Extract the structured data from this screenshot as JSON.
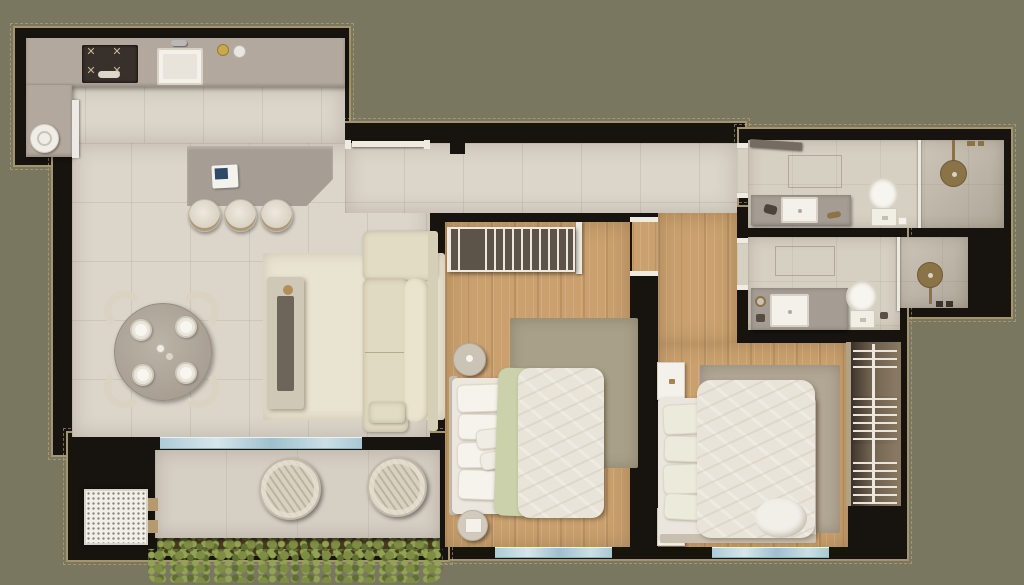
{
  "scene": {
    "kind": "3D-rendered apartment floor plan, top-down view",
    "background_color": "#7a7761",
    "wall_color": "#17130f",
    "outline_color": "#a4946f"
  },
  "palette": {
    "tile_floor": "#dbd5ca",
    "wood_floor": "#c9a06e",
    "bathroom_floor": "#d6d0c3",
    "counter_gray": "#b3a89d",
    "island_gray": "#a69e94",
    "sofa_cream": "#e3dcc5",
    "bedding_white": "#e9e4d9",
    "throw_green": "#cbd1ab",
    "glass_blue": "#aecbd7",
    "fixture_bronze": "#8a7347",
    "plant_green": "#7e8d44",
    "planter_soil": "#46381f"
  },
  "rooms": [
    {
      "id": "kitchen",
      "floor": "tile",
      "items": [
        "L-counter",
        "cooktop-4-burners",
        "kitchen-sink",
        "faucet",
        "two-canisters",
        "washer",
        "tall-cabinet",
        "island-with-laptop",
        "three-bar-stools"
      ]
    },
    {
      "id": "living-dining",
      "floor": "tile",
      "items": [
        "round-dining-table",
        "four-dining-chairs",
        "four-place-settings",
        "area-rug",
        "coffee-table-with-tray",
        "l-shaped-sofa"
      ]
    },
    {
      "id": "hallway",
      "floor": "wood",
      "items": []
    },
    {
      "id": "bedroom-1",
      "floor": "wood",
      "items": [
        "wall-shelf-unit",
        "open-door-leaf",
        "round-nightstand",
        "double-bed-green-throw",
        "area-rug",
        "round-side-table",
        "window"
      ]
    },
    {
      "id": "bedroom-2",
      "floor": "wood",
      "items": [
        "nightstand-upper",
        "nightstand-lower",
        "double-bed",
        "area-rug",
        "open-wardrobe-with-rail",
        "window"
      ]
    },
    {
      "id": "bathroom-1",
      "floor": "tile",
      "items": [
        "door-leaf",
        "vanity-with-sink",
        "toilet",
        "glass-divider",
        "rain-shower-head",
        "shower-controls"
      ]
    },
    {
      "id": "bathroom-2",
      "floor": "tile",
      "items": [
        "vanity-with-sink",
        "round-mirror",
        "toilet",
        "glass-divider",
        "rain-shower-head"
      ]
    },
    {
      "id": "balcony",
      "floor": "tile",
      "items": [
        "sliding-glass-door",
        "ac-condenser-grille",
        "two-papasan-chairs",
        "planter-with-greenery"
      ]
    }
  ],
  "windows": [
    {
      "id": "balcony-glass-door",
      "wall": "south-living"
    },
    {
      "id": "bedroom-1-window",
      "wall": "south"
    },
    {
      "id": "bedroom-2-window",
      "wall": "south"
    }
  ]
}
